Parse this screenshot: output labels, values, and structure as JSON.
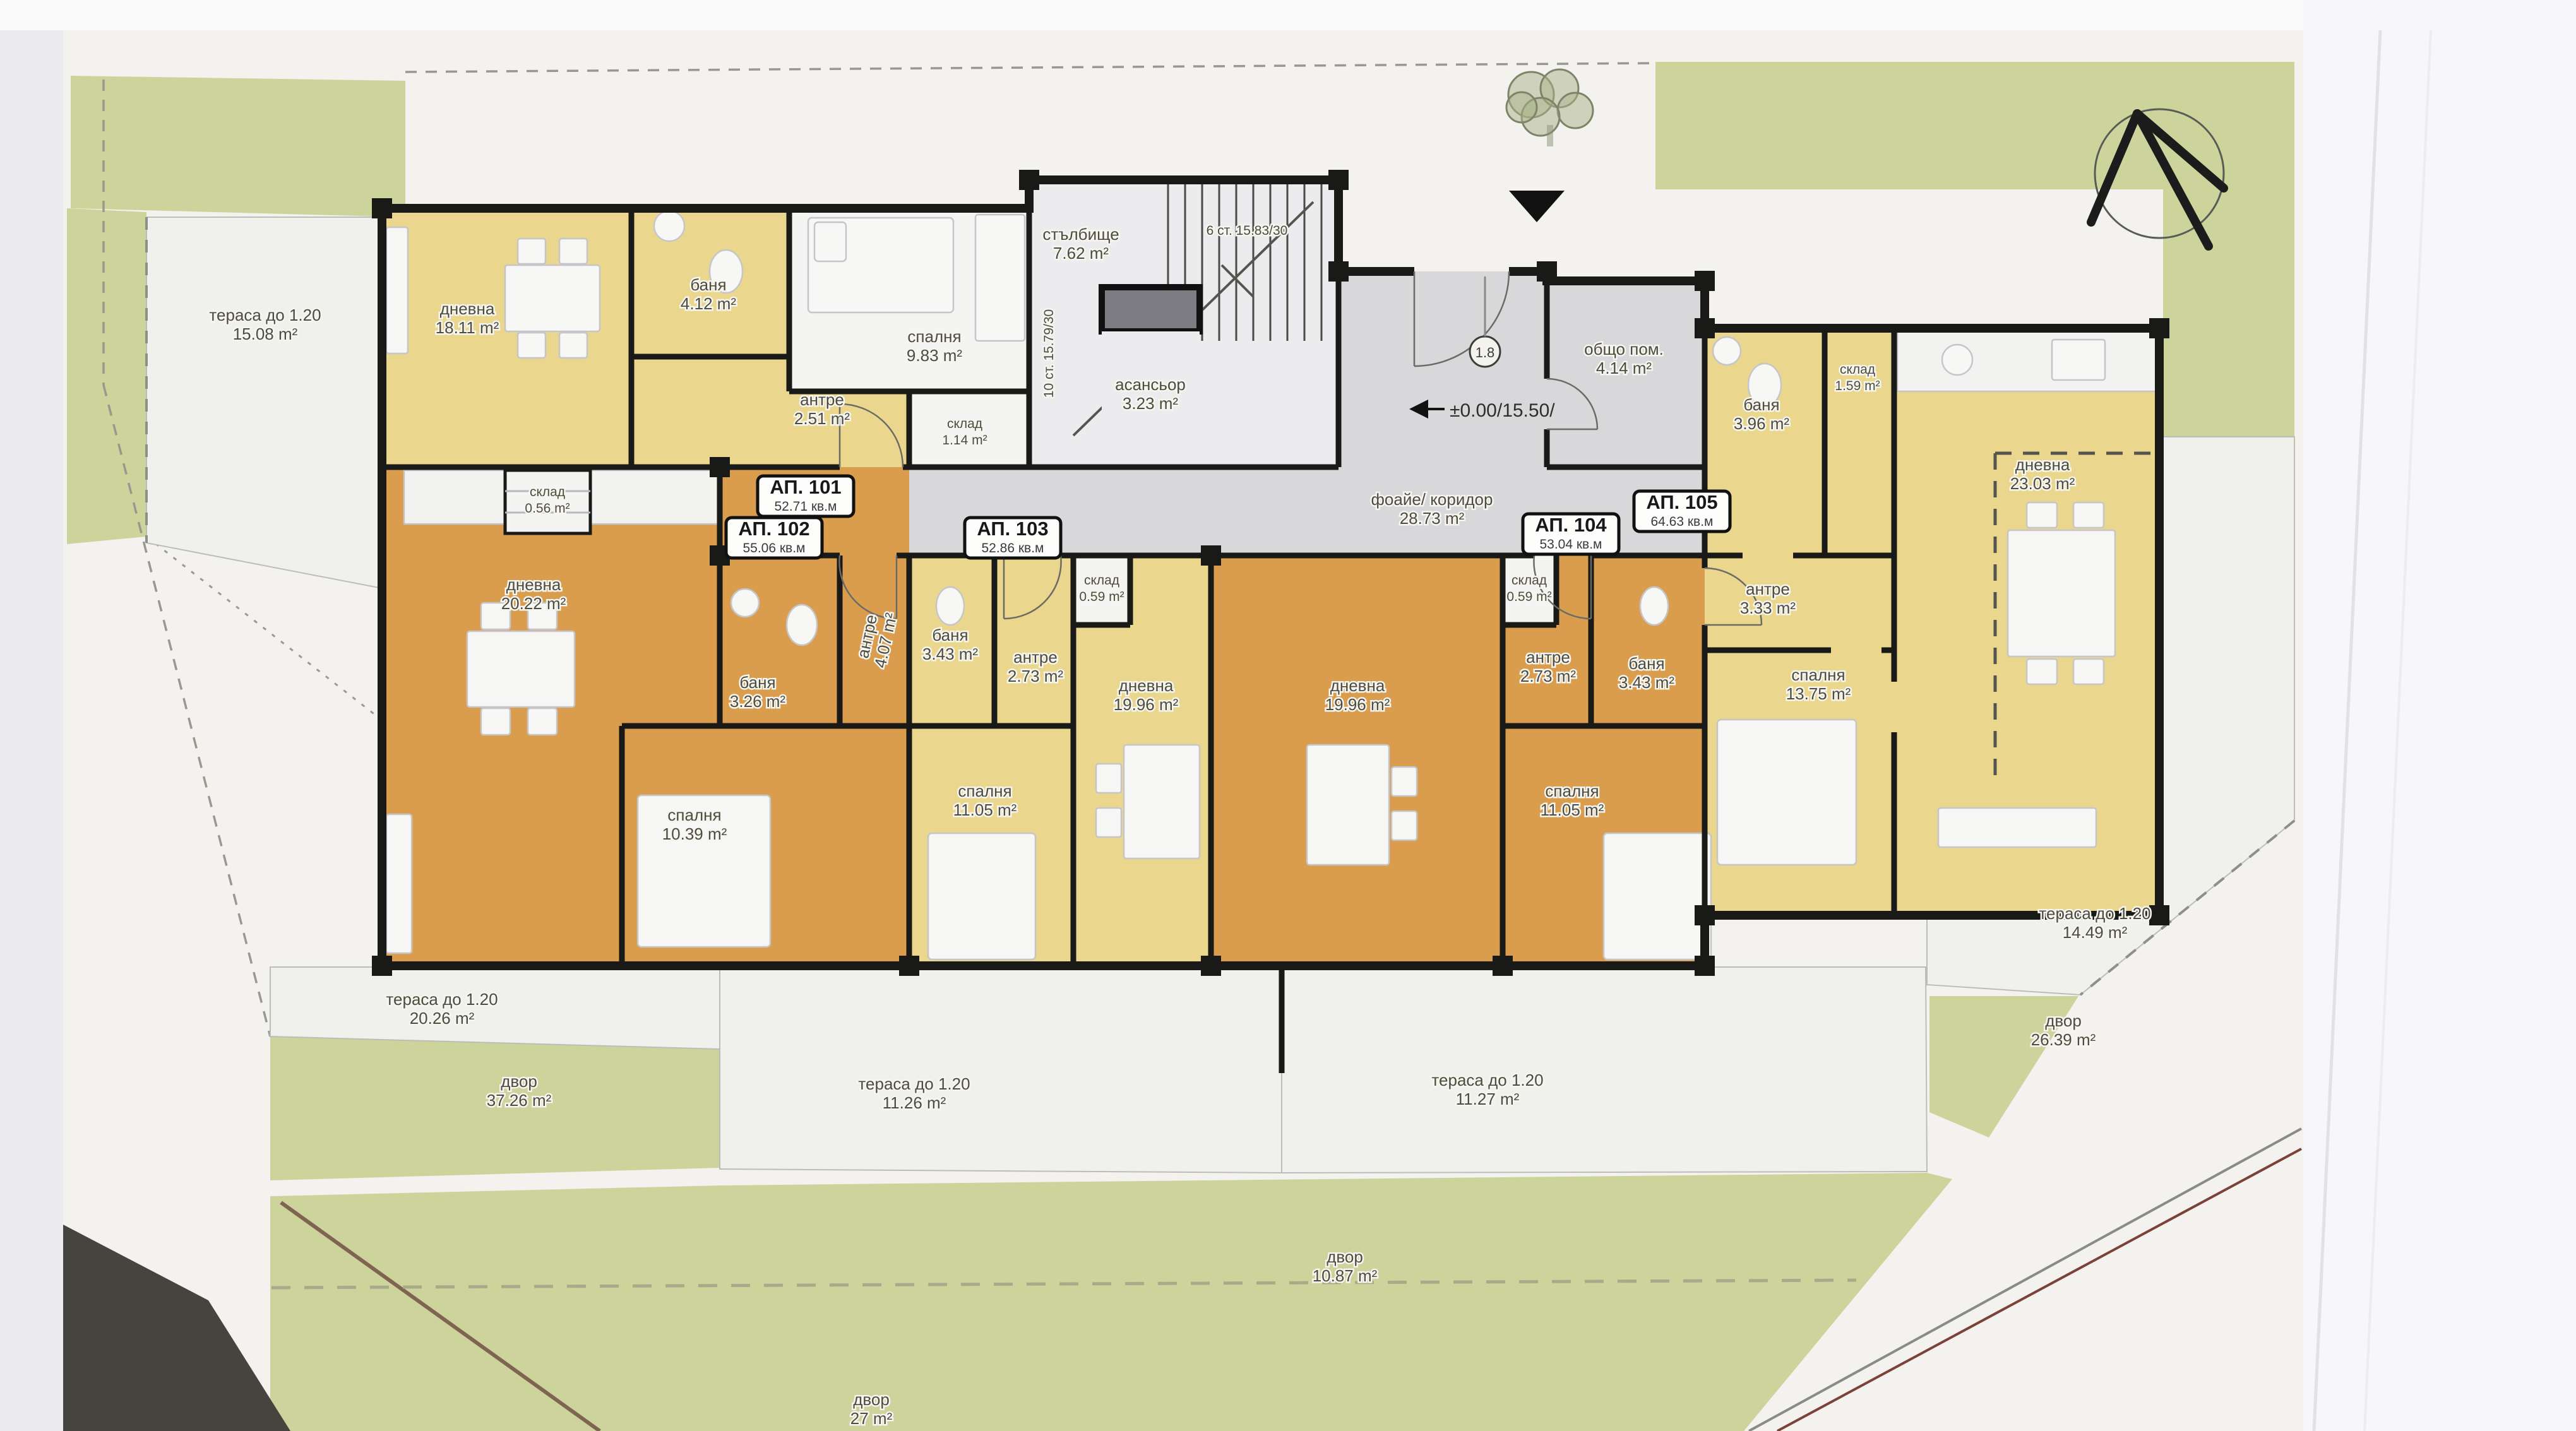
{
  "apartments": [
    {
      "id": "АП. 101",
      "total": "52.71 кв.м",
      "rooms": {
        "living": {
          "name": "дневна",
          "area": "18.11 m²"
        },
        "bath": {
          "name": "баня",
          "area": "4.12 m²"
        },
        "hall": {
          "name": "антре",
          "area": "2.51 m²"
        },
        "bedroom": {
          "name": "спалня",
          "area": "9.83 m²"
        },
        "storage": {
          "name": "склад",
          "area": "1.14 m²"
        }
      }
    },
    {
      "id": "АП. 102",
      "total": "55.06 кв.м",
      "rooms": {
        "living": {
          "name": "дневна",
          "area": "20.22 m²"
        },
        "bath": {
          "name": "баня",
          "area": "3.26 m²"
        },
        "hall": {
          "name": "антре",
          "area": "4.07 m²"
        },
        "bedroom": {
          "name": "спалня",
          "area": "10.39 m²"
        },
        "storage": {
          "name": "склад",
          "area": "0.56 m²"
        }
      }
    },
    {
      "id": "АП. 103",
      "total": "52.86 кв.м",
      "rooms": {
        "living": {
          "name": "дневна",
          "area": "19.96 m²"
        },
        "bath": {
          "name": "баня",
          "area": "3.43 m²"
        },
        "hall": {
          "name": "антре",
          "area": "2.73 m²"
        },
        "bedroom": {
          "name": "спалня",
          "area": "11.05 m²"
        },
        "storage": {
          "name": "склад",
          "area": "0.59 m²"
        }
      }
    },
    {
      "id": "АП. 104",
      "total": "53.04 кв.м",
      "rooms": {
        "living": {
          "name": "дневна",
          "area": "19.96 m²"
        },
        "bath": {
          "name": "баня",
          "area": "3.43 m²"
        },
        "hall": {
          "name": "антре",
          "area": "2.73 m²"
        },
        "bedroom": {
          "name": "спалня",
          "area": "11.05 m²"
        },
        "storage": {
          "name": "склад",
          "area": "0.59 m²"
        }
      }
    },
    {
      "id": "АП. 105",
      "total": "64.63 кв.м",
      "rooms": {
        "living": {
          "name": "дневна",
          "area": "23.03 m²"
        },
        "bath": {
          "name": "баня",
          "area": "3.96 m²"
        },
        "hall": {
          "name": "антре",
          "area": "3.33 m²"
        },
        "bedroom": {
          "name": "спалня",
          "area": "13.75 m²"
        },
        "storage": {
          "name": "склад",
          "area": "1.59 m²"
        }
      }
    }
  ],
  "common": {
    "stairwell": {
      "name": "стълбище",
      "area": "7.62 m²"
    },
    "stair_run_top": "6 ст. 15.83/30",
    "stair_run_side": "10 ст. 15.79/30",
    "elevator": {
      "name": "асансьор",
      "area": "3.23 m²"
    },
    "foyer": {
      "name": "фоайе/ коридор",
      "area": "28.73 m²"
    },
    "common_room": {
      "name": "общо пом.",
      "area": "4.14 m²"
    },
    "elevation": "±0.00/15.50/",
    "level_badge": "1.8"
  },
  "site": {
    "terrace_left": {
      "name": "тераса до 1.20",
      "area": "15.08 m²"
    },
    "terrace_sw": {
      "name": "тераса до 1.20",
      "area": "20.26 m²"
    },
    "terrace_s1": {
      "name": "тераса до 1.20",
      "area": "11.26 m²"
    },
    "terrace_s2": {
      "name": "тераса до 1.20",
      "area": "11.27 m²"
    },
    "terrace_se": {
      "name": "тераса до 1.20",
      "area": "14.49 m²"
    },
    "yard_w": {
      "name": "двор",
      "area": "37.26 m²"
    },
    "yard_s": {
      "name": "двор",
      "area": "27 m²"
    },
    "yard_sm": {
      "name": "двор",
      "area": "10.87 m²"
    },
    "yard_se": {
      "name": "двор",
      "area": "26.39 m²"
    }
  },
  "colors": {
    "yellow_apartment": "#ead68c",
    "orange_apartment": "#d99d4d",
    "corridor_gray": "#d8d8da",
    "yard_green": "#ccd49c",
    "wall_black": "#191917",
    "sheet_white": "#f3f2ef"
  }
}
